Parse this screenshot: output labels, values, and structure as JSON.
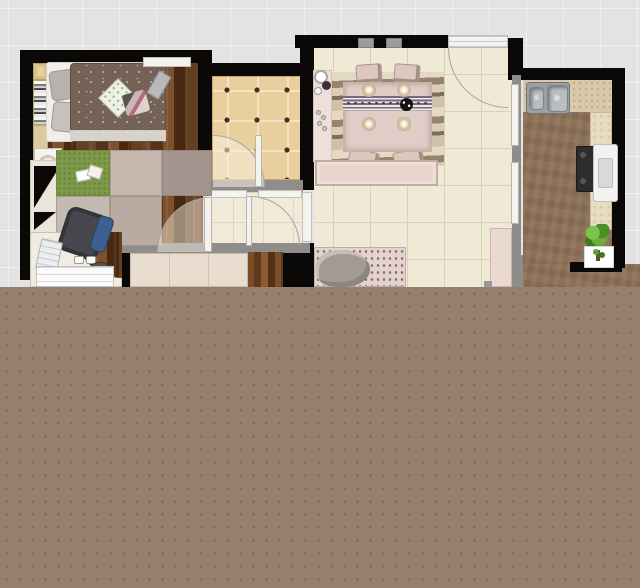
{
  "scene": {
    "type": "apartment-floor-plan-render",
    "view": "top-down",
    "note": "lower half of image is a flat dotted brown panel (plan cut off)"
  },
  "palette": {
    "background": "#e3e3e3",
    "grid_line": "#f0f0f0",
    "wall_black": "#0b0908",
    "wall_gray": "#8f8d8a",
    "footer_brown": "#97806c",
    "bedroom_wood": "#5e3a20",
    "bathroom_tile": "#e9cf9d",
    "living_tile": "#efe9d5",
    "hall_tile": "#f1ead8",
    "kitchen_floor": "#8d7157",
    "counter": "#d9c8ab",
    "rug_green": "#7d9a48",
    "carpet_mauve": "#b9aaa2",
    "dining_pink": "#e0cdc7",
    "duvet_brown": "#756257"
  },
  "rooms": [
    {
      "name": "bedroom",
      "floor": "dark wood planks",
      "furniture": [
        "double-bed with brown duvet",
        "gray pillows",
        "diamond pillow",
        "wardrobe-bookshelf strip",
        "nightstand with lamp",
        "corner cabinet with black triangles",
        "green rug with papers",
        "mauve carpet patches",
        "curved desk",
        "office chair with blue pad",
        "laptop",
        "drawer unit",
        "wall shelf",
        "desk lamp",
        "door swing arc"
      ]
    },
    {
      "name": "bathroom",
      "floor": "tan tiles with dark grout dots",
      "furniture": [
        "door leaf",
        "door swing arc"
      ]
    },
    {
      "name": "hallway",
      "floor": "cream tiles",
      "furniture": [
        "door leaf",
        "door swing arc",
        "low cabinet",
        "wood strip"
      ]
    },
    {
      "name": "dining-living-room",
      "floor": "cream large tiles",
      "furniture": [
        "wavy-pattern rug",
        "dining table with striped runner",
        "4 plates",
        "black flower centerpiece",
        "4 chairs",
        "side console with decor plates and beads",
        "sideboard",
        "patterned sofa-bed with gray blanket",
        "tall cabinet",
        "entry door with swing arc",
        "two windows in top wall"
      ]
    },
    {
      "name": "kitchen",
      "floor": "brown textured",
      "furniture": [
        "double-basin stainless sink",
        "speckled counters",
        "stove",
        "white appliance",
        "green plant",
        "white plant box",
        "sliding door panels"
      ]
    }
  ]
}
